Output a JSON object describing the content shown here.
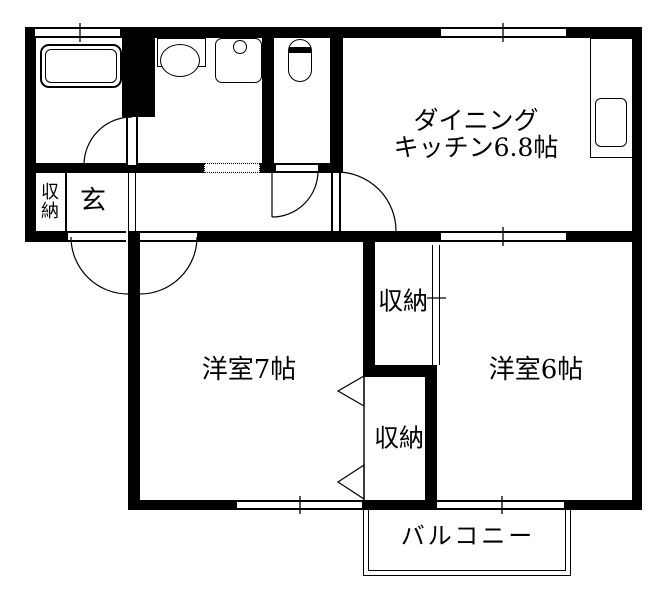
{
  "rooms": {
    "dining_kitchen": {
      "name_line1": "ダイニング",
      "name_line2": "キッチン6.8帖"
    },
    "western_room_7": {
      "name": "洋室7帖"
    },
    "western_room_6": {
      "name": "洋室6帖"
    },
    "balcony": {
      "name": "バルコニー"
    },
    "entrance": {
      "name": "玄"
    },
    "entrance_storage": {
      "name": "収納"
    },
    "upper_storage": {
      "name": "収納"
    },
    "lower_storage": {
      "name": "収納"
    }
  },
  "colors": {
    "wall": "#000000",
    "background": "#ffffff",
    "line": "#000000"
  }
}
